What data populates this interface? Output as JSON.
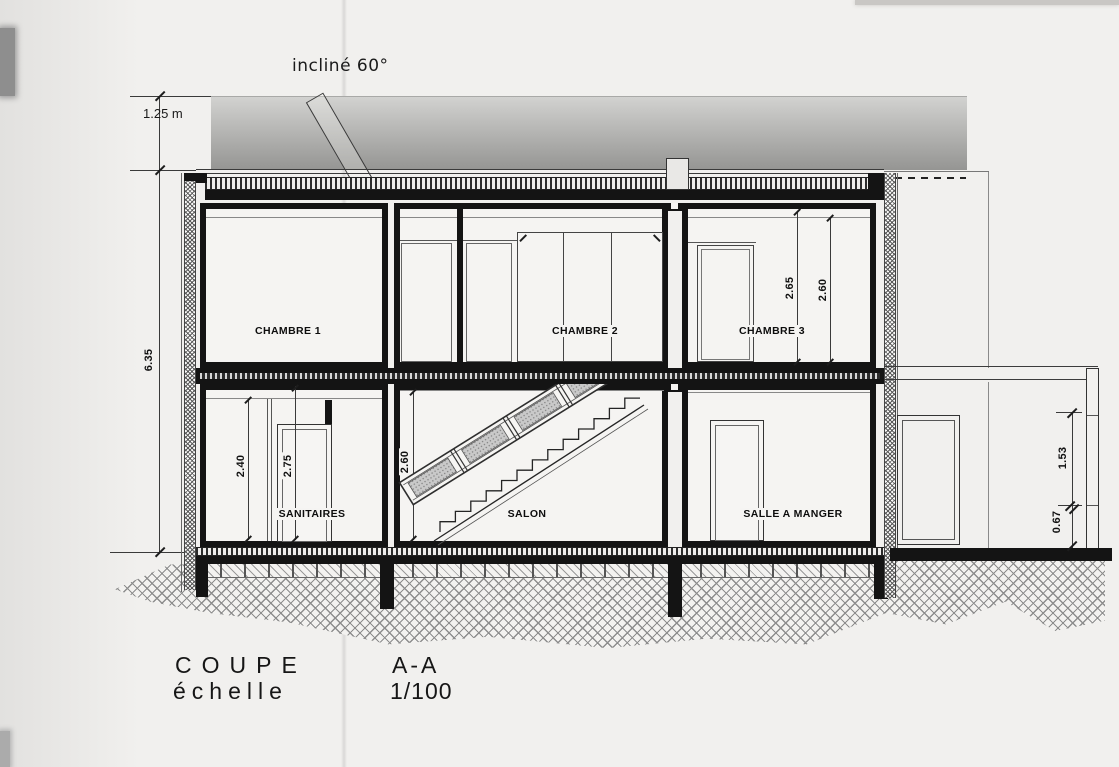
{
  "labels": {
    "incline": "incliné 60°",
    "roof_offset": "1.25 m",
    "total_height": "6.35",
    "chambre1": "CHAMBRE 1",
    "chambre2": "CHAMBRE 2",
    "chambre3": "CHAMBRE 3",
    "sanitaires": "SANITAIRES",
    "salon": "SALON",
    "salle_a_manger": "SALLE A MANGER"
  },
  "dimensions": {
    "chambre3_a": "2.65",
    "chambre3_b": "2.60",
    "sanitaires_a": "2.40",
    "sanitaires_b": "2.75",
    "salon": "2.60",
    "annex_a": "1.53",
    "annex_b": "0.67"
  },
  "title": {
    "name": "COUPE",
    "section": "A-A",
    "scale_label": "échelle",
    "scale_value": "1/100"
  },
  "colors": {
    "ink": "#141414",
    "paper": "#f1f0ee",
    "roof_band_top": "#d2d2d0",
    "roof_band_bottom": "#959593"
  }
}
